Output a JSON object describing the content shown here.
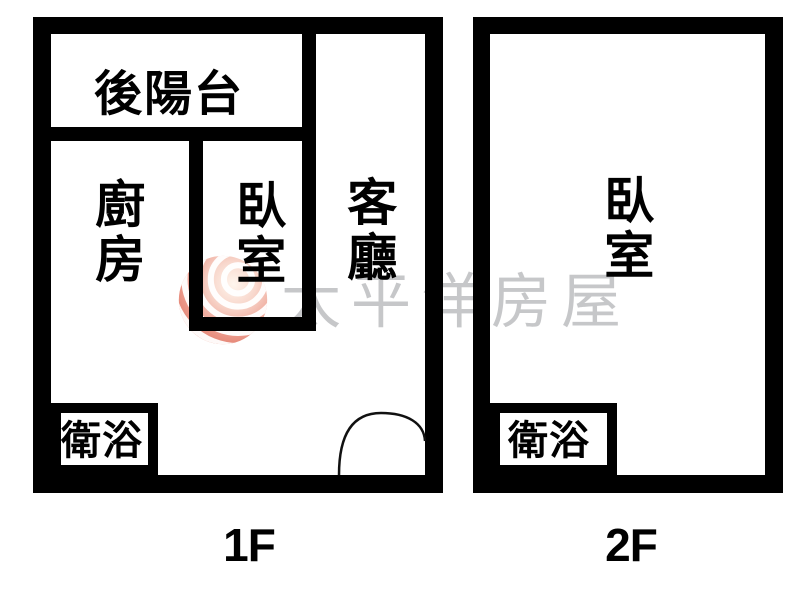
{
  "title": "two-storey apartment floor plan",
  "colors": {
    "wall": "#000000",
    "room_fill": "#ffffff",
    "label_text": "#000000",
    "watermark_gray": "#c6c7c9",
    "logo_red_deep": "#dd6a58",
    "logo_red_mid": "#eda193",
    "logo_highlight": "#fff6ee"
  },
  "watermark": {
    "brand_text": "太平洋房屋",
    "logo": "pacific-globe-logo"
  },
  "floors": [
    {
      "caption": "1F",
      "rooms": {
        "balcony": "後陽台",
        "kitchen": "廚房",
        "bedroom": "臥室",
        "living": "客廳",
        "bath": "衛浴"
      }
    },
    {
      "caption": "2F",
      "rooms": {
        "bedroom": "臥室",
        "bath": "衛浴"
      }
    }
  ]
}
